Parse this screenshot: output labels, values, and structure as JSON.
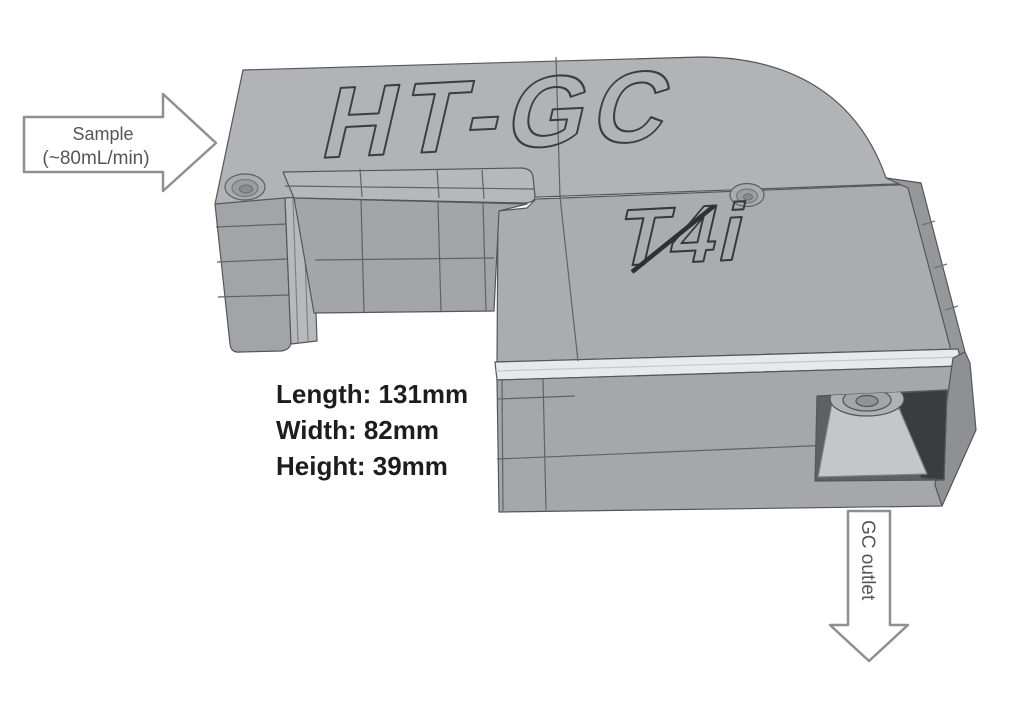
{
  "figure": {
    "device_name_engraving": "HT-GC",
    "brand_logo_engraving": "T4i",
    "inlet_arrow": {
      "label_line1": "Sample",
      "label_line2": "(~80mL/min)"
    },
    "outlet_arrow": {
      "label": "GC outlet"
    },
    "dimensions": {
      "length_label": "Length: 131mm",
      "width_label": "Width: 82mm",
      "height_label": "Height: 39mm"
    }
  },
  "colors": {
    "background": "#ffffff",
    "body_gray": "#b1b3b6",
    "body_gray_dark": "#a4a6a9",
    "chamfer_light": "#e8e9ea",
    "opening_dark": "#3a3c3e",
    "edge_line": "#54565a",
    "engraving_line": "#3b3d3f",
    "annotation_outline": "#8d8f91",
    "annotation_text": "#54565a",
    "dimension_text": "#1d1d1d"
  }
}
